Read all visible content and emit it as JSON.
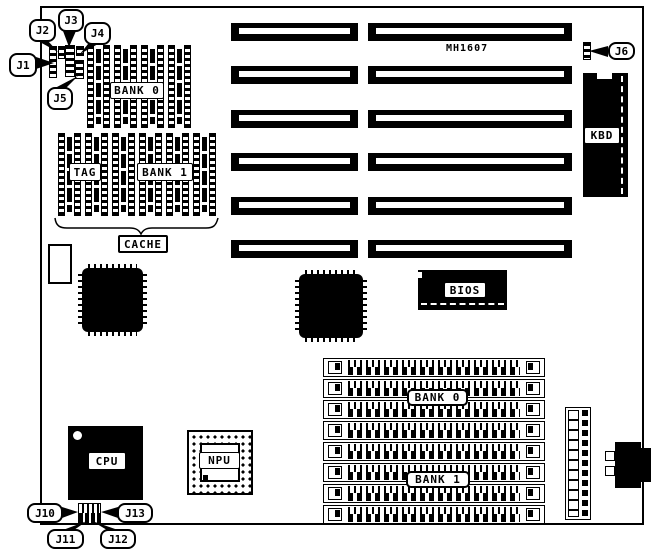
{
  "diagram": {
    "model": "MH1607",
    "labels": {
      "dip_bank0": "BANK 0",
      "tag": "TAG",
      "dip_bank1": "BANK 1",
      "cache": "CACHE",
      "kbd": "KBD",
      "bios": "BIOS",
      "cpu": "CPU",
      "npu": "NPU",
      "simm_bank0": "BANK 0",
      "simm_bank1": "BANK 1"
    },
    "jumpers": {
      "j1": "J1",
      "j2": "J2",
      "j3": "J3",
      "j4": "J4",
      "j5": "J5",
      "j6": "J6",
      "j10": "J10",
      "j11": "J11",
      "j12": "J12",
      "j13": "J13"
    },
    "colors": {
      "ink": "#000000",
      "paper": "#ffffff"
    }
  }
}
